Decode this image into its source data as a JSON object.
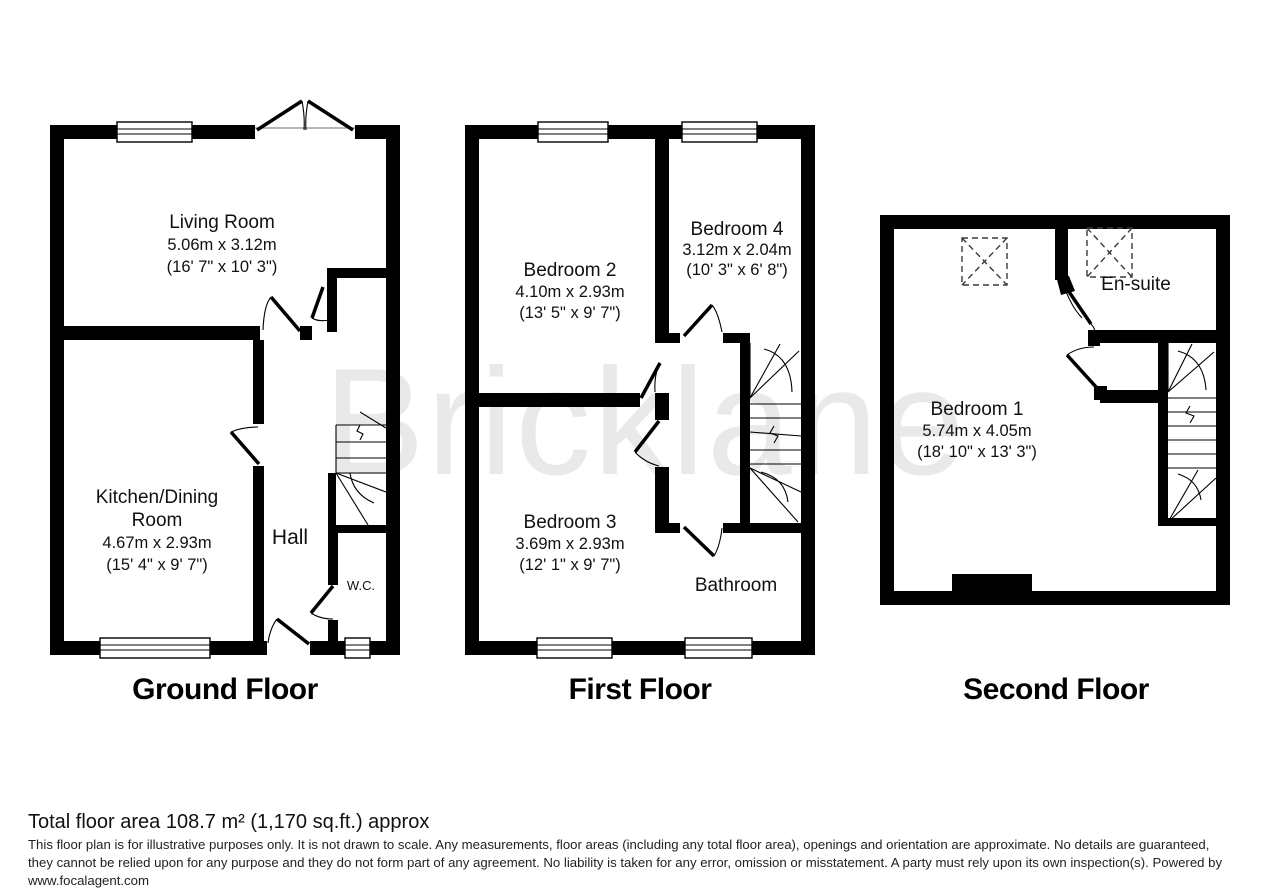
{
  "watermark": "Bricklane",
  "colors": {
    "wall": "#000000",
    "watermark": "#e8e9e8",
    "background": "#ffffff",
    "text": "#111111"
  },
  "ground": {
    "title": "Ground Floor",
    "living": {
      "name": "Living Room",
      "dim_m": "5.06m x 3.12m",
      "dim_ft": "(16' 7\" x 10' 3\")"
    },
    "kitchen": {
      "name_line1": "Kitchen/Dining",
      "name_line2": "Room",
      "dim_m": "4.67m x 2.93m",
      "dim_ft": "(15' 4\" x 9' 7\")"
    },
    "hall": "Hall",
    "wc": "W.C."
  },
  "first": {
    "title": "First Floor",
    "bed2": {
      "name": "Bedroom 2",
      "dim_m": "4.10m x 2.93m",
      "dim_ft": "(13' 5\" x 9' 7\")"
    },
    "bed4": {
      "name": "Bedroom 4",
      "dim_m": "3.12m x 2.04m",
      "dim_ft": "(10' 3\" x 6' 8\")"
    },
    "bed3": {
      "name": "Bedroom 3",
      "dim_m": "3.69m x 2.93m",
      "dim_ft": "(12' 1\" x 9' 7\")"
    },
    "bathroom": "Bathroom"
  },
  "second": {
    "title": "Second Floor",
    "bed1": {
      "name": "Bedroom 1",
      "dim_m": "5.74m x 4.05m",
      "dim_ft": "(18' 10\" x 13' 3\")"
    },
    "ensuite": "En-suite"
  },
  "footer": {
    "total_area": "Total floor area 108.7 m² (1,170 sq.ft.) approx",
    "disclaimer_line1": "This floor plan is for illustrative purposes only. It is not drawn to scale. Any measurements, floor areas (including any total floor area), openings and orientation are approximate. No details are guaranteed,",
    "disclaimer_line2": "they cannot be relied upon for any purpose and they do not form part of any agreement. No liability is taken for any error, omission or misstatement. A party must rely upon its own inspection(s). Powered by",
    "disclaimer_line3": "www.focalagent.com"
  }
}
